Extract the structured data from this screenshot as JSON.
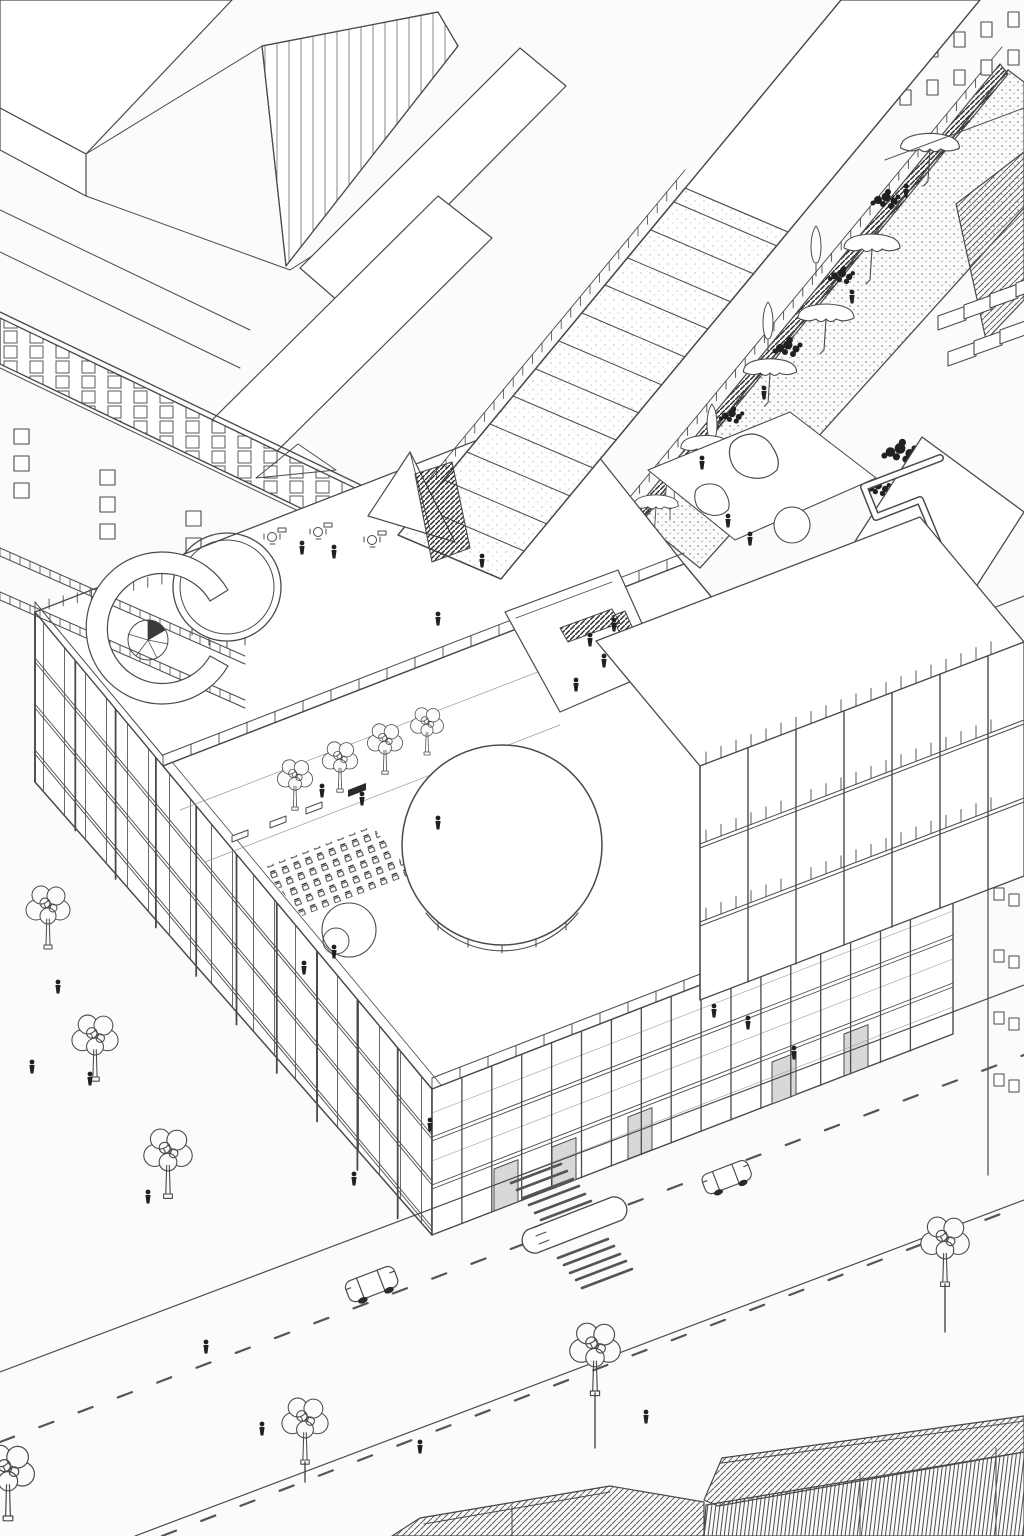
{
  "scene": {
    "type": "axonometric architectural line drawing",
    "subject": "aerial axonometric of an urban block: cultural building with rooftop terraces, large circular drum skylight, ridged skylight roof, roof garden with umbrella canopies, open structural frame building, street with cars, crosswalk, trees and pedestrians"
  },
  "colors": {
    "background": "#fbfbf9",
    "ink": "#4a4a4a",
    "ink_light": "#8d8d8d",
    "dark_fill": "#212121",
    "paper_white": "#ffffff",
    "pane_gray": "#d8d8d6"
  },
  "counts": {
    "cars": 2,
    "garden_umbrellas": 6,
    "street_and_plaza_trees": 7,
    "courtyard_trees": 4,
    "rooftop_canopies": 3,
    "pedestrians": 32
  }
}
